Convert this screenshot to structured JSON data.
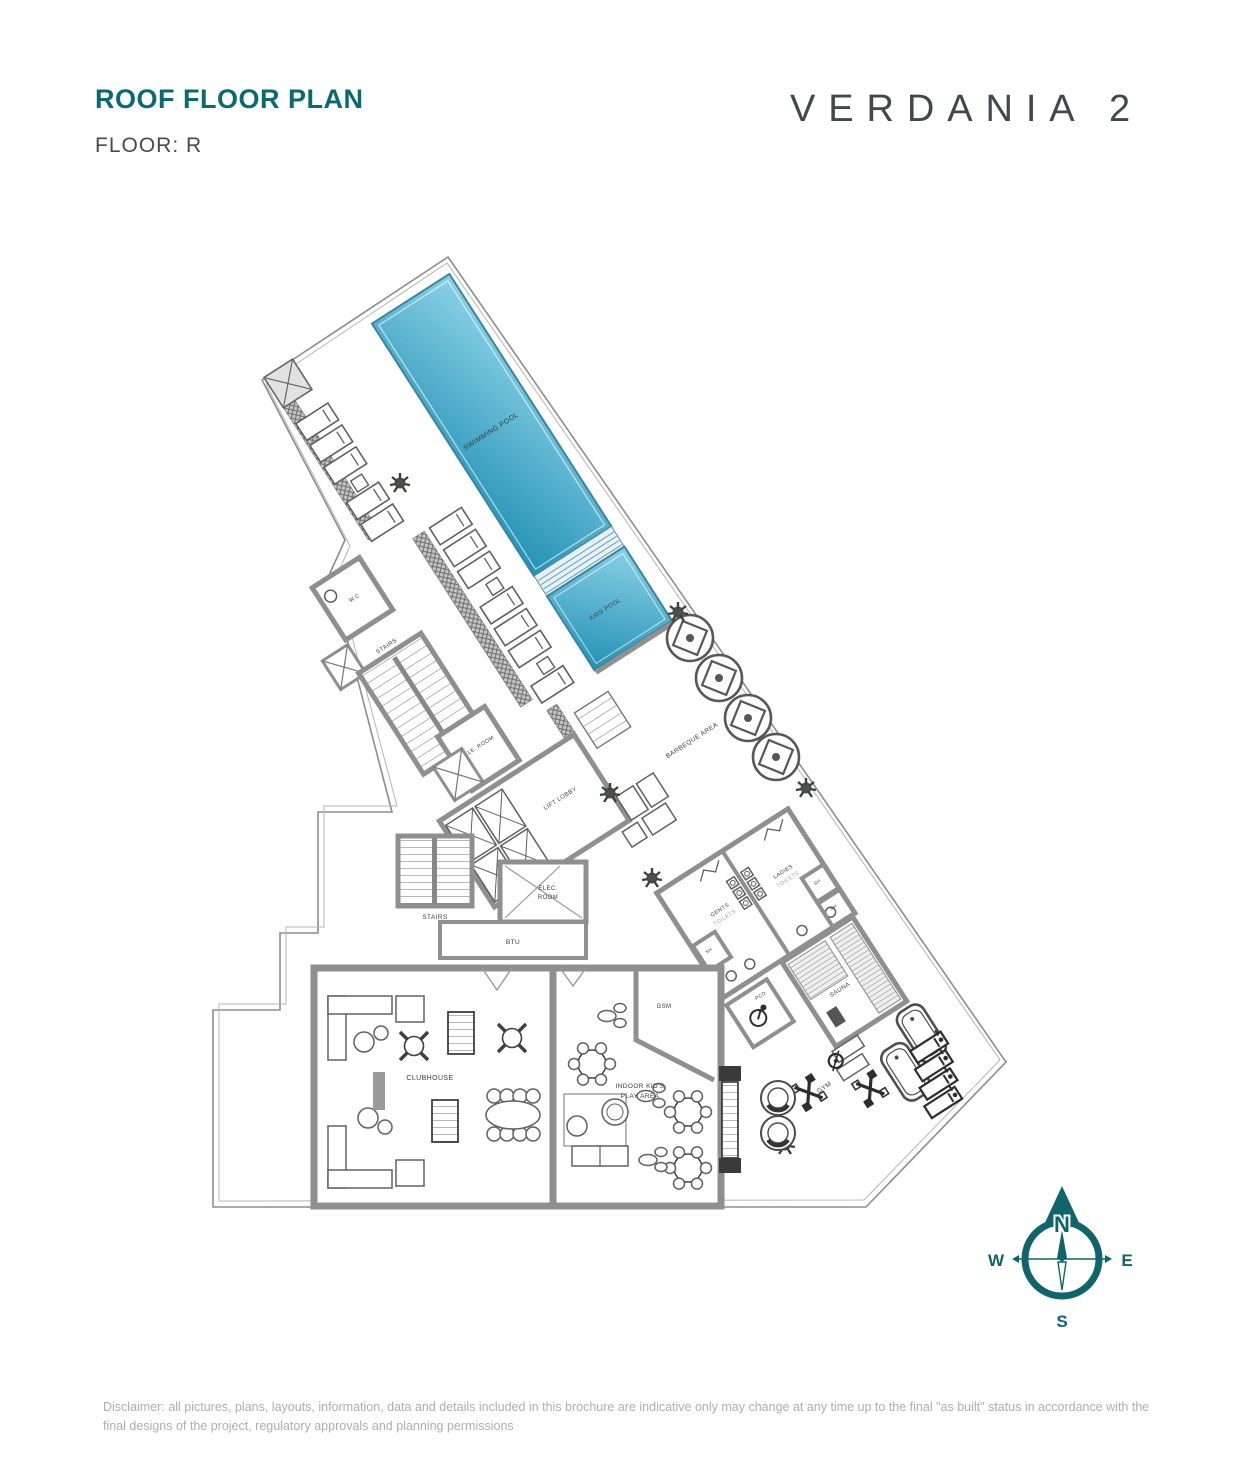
{
  "header": {
    "title": "ROOF FLOOR PLAN",
    "floor_label": "FLOOR: R",
    "brand": "VERDANIA 2"
  },
  "plan": {
    "labels": {
      "swimming_pool": "SWIMMING POOL",
      "kids_pool": "KIDS POOL",
      "barbeque_area": "BARBEQUE AREA",
      "lift_lobby": "LIFT LOBBY",
      "stairs": "STAIRS",
      "tele_room": "TELE. ROOM",
      "wc": "W.C",
      "elec_room_line1": "ELEC.",
      "elec_room_line2": "ROOM",
      "btu": "BTU",
      "gents": "GENTS",
      "ladies": "LADIES",
      "toilets": "TOILETS",
      "sh": "SH",
      "sauna": "SAUNA",
      "pcd": "PCD",
      "gsm": "GSM",
      "indoor_kids_line1": "INDOOR KID'S",
      "indoor_kids_line2": "PLAY AREA",
      "clubhouse": "CLUBHOUSE",
      "gym": "GYM"
    }
  },
  "compass": {
    "north": "N",
    "east": "E",
    "south": "S",
    "west": "W"
  },
  "footer": {
    "disclaimer": "Disclaimer: all pictures, plans, layouts, information, data and details included in this brochure are indicative only may change at any time up to the final \"as built\" status in accordance with the final designs of the project, regulatory approvals and planning permissions"
  },
  "colors": {
    "accent_teal": "#0b6a70",
    "compass_teal": "#11646b",
    "pool_light": "#85cde3",
    "pool_dark": "#2391b5",
    "wall_gray": "#909090"
  }
}
